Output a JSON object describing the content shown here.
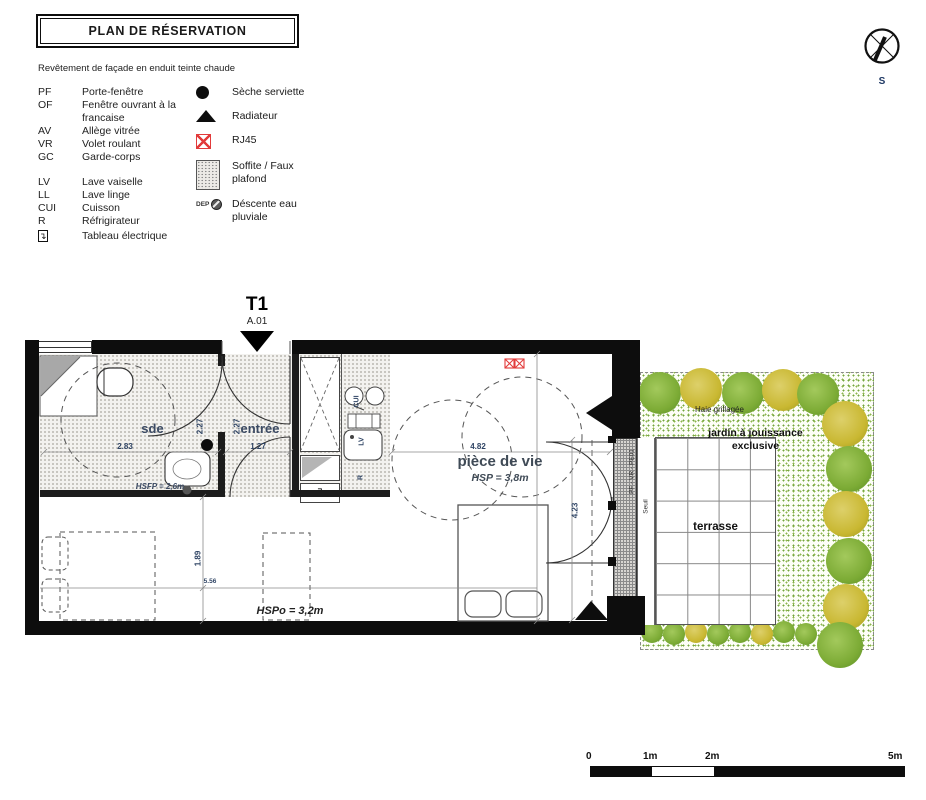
{
  "title": "PLAN DE RÉSERVATION",
  "facade_note": "Revêtement de façade en enduit teinte chaude",
  "compass": {
    "south_label": "S"
  },
  "legend": {
    "abbreviations": [
      {
        "abbr": "PF",
        "label": "Porte-fenêtre"
      },
      {
        "abbr": "OF",
        "label": "Fenêtre ouvrant à la francaise"
      },
      {
        "abbr": "AV",
        "label": "Allège vitrée"
      },
      {
        "abbr": "VR",
        "label": "Volet roulant"
      },
      {
        "abbr": "GC",
        "label": "Garde-corps"
      },
      {
        "abbr": "LV",
        "label": "Lave vaiselle"
      },
      {
        "abbr": "LL",
        "label": "Lave linge"
      },
      {
        "abbr": "CUI",
        "label": "Cuisson"
      },
      {
        "abbr": "R",
        "label": "Réfrigirateur"
      },
      {
        "abbr": "",
        "label": "Tableau électrique"
      }
    ],
    "symbols": [
      {
        "name": "seche-serviette",
        "label": "Sèche serviette"
      },
      {
        "name": "radiateur",
        "label": "Radiateur"
      },
      {
        "name": "rj45",
        "label": "RJ45"
      },
      {
        "name": "soffite",
        "label": "Soffite / Faux plafond"
      },
      {
        "name": "descente-eau-pluviale",
        "label": "Déscente eau pluviale",
        "prefix": "DEP"
      }
    ]
  },
  "unit": {
    "type_label": "T1",
    "lot_label": "A.01"
  },
  "plan": {
    "rooms": {
      "sde": "sde",
      "sde_height": "HSFP = 2,6m",
      "entree": "entrée",
      "piece_de_vie": "pièce de vie",
      "piece_de_vie_height": "HSP = 3,8m",
      "living_height": "HSPo = 3,2m",
      "terrasse": "terrasse",
      "jardin_line1": "jardin à jouissance",
      "jardin_line2": "exclusive",
      "haie": "Haie grillagée"
    },
    "equipment": {
      "cui": "CUI",
      "lv": "LV",
      "r": "R"
    },
    "dimensions": {
      "sde_width": "2.83",
      "sde_depth": "2.27",
      "entree_depth": "2.27",
      "entree_width": "1.27",
      "vie_width": "4.82",
      "vie_depth": "4.23",
      "bed_zone": "1.89",
      "total_width": "5.56"
    },
    "window_spec": "PF - VR - PE01",
    "seuil": "Seuil"
  },
  "scalebar": {
    "labels": [
      "0",
      "1m",
      "2m",
      "5m"
    ]
  },
  "colors": {
    "wall": "#0d0d0d",
    "dim_text": "#2f4464",
    "room_text": "#3b4a63",
    "rj45_red": "#e23b3b",
    "garden_green": "#74a63c",
    "shrub_yellow": "#c9b832"
  }
}
